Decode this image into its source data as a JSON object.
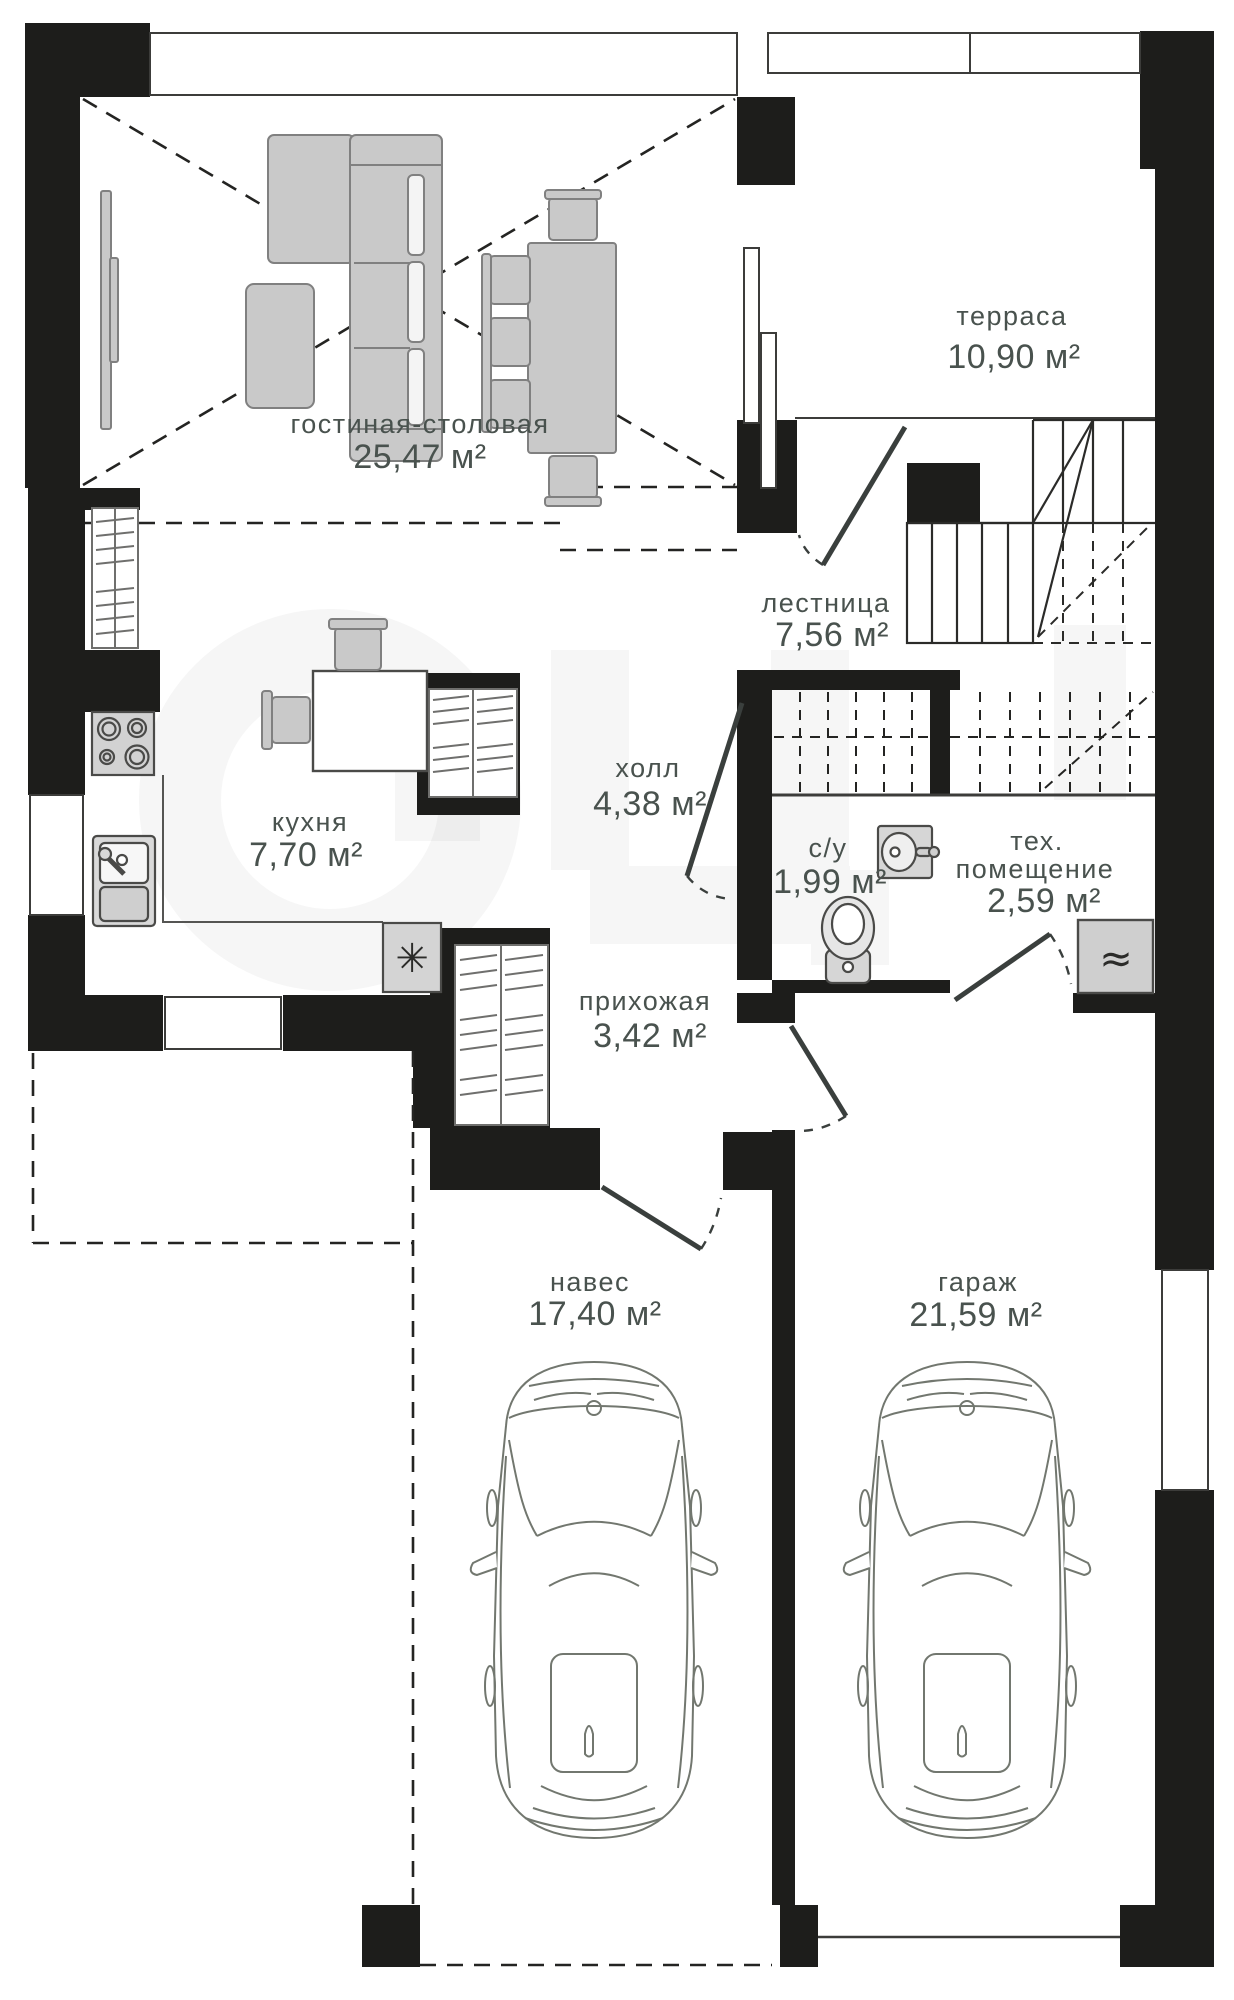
{
  "plan": {
    "type": "floor-plan",
    "language": "ru",
    "rooms": [
      {
        "id": "living",
        "name": "гостиная-столовая",
        "area": "25,47 м²"
      },
      {
        "id": "terrace",
        "name": "терраса",
        "area": "10,90 м²"
      },
      {
        "id": "stairs",
        "name": "лестница",
        "area": "7,56 м²"
      },
      {
        "id": "hall",
        "name": "холл",
        "area": "4,38 м²"
      },
      {
        "id": "kitchen",
        "name": "кухня",
        "area": "7,70 м²"
      },
      {
        "id": "wc",
        "name": "с/у",
        "area": "1,99 м²"
      },
      {
        "id": "tech",
        "name": "тех. помещение",
        "name_line1": "тех.",
        "name_line2": "помещение",
        "area": "2,59 м²"
      },
      {
        "id": "entry",
        "name": "прихожая",
        "area": "3,42 м²"
      },
      {
        "id": "carport",
        "name": "навес",
        "area": "17,40 м²"
      },
      {
        "id": "garage",
        "name": "гараж",
        "area": "21,59 м²"
      }
    ],
    "icons": {
      "washer_glyph": "✳",
      "boiler_glyph": "≈"
    },
    "watermark": {
      "note": "faint large letterforms across center"
    },
    "colors": {
      "wall": "#1d1d1b",
      "furniture_fill": "#c9c9c9",
      "furniture_stroke": "#808080",
      "thin_line": "#3c3c3a",
      "label_text": "#49524e",
      "watermark": "#2a2a2a"
    }
  }
}
